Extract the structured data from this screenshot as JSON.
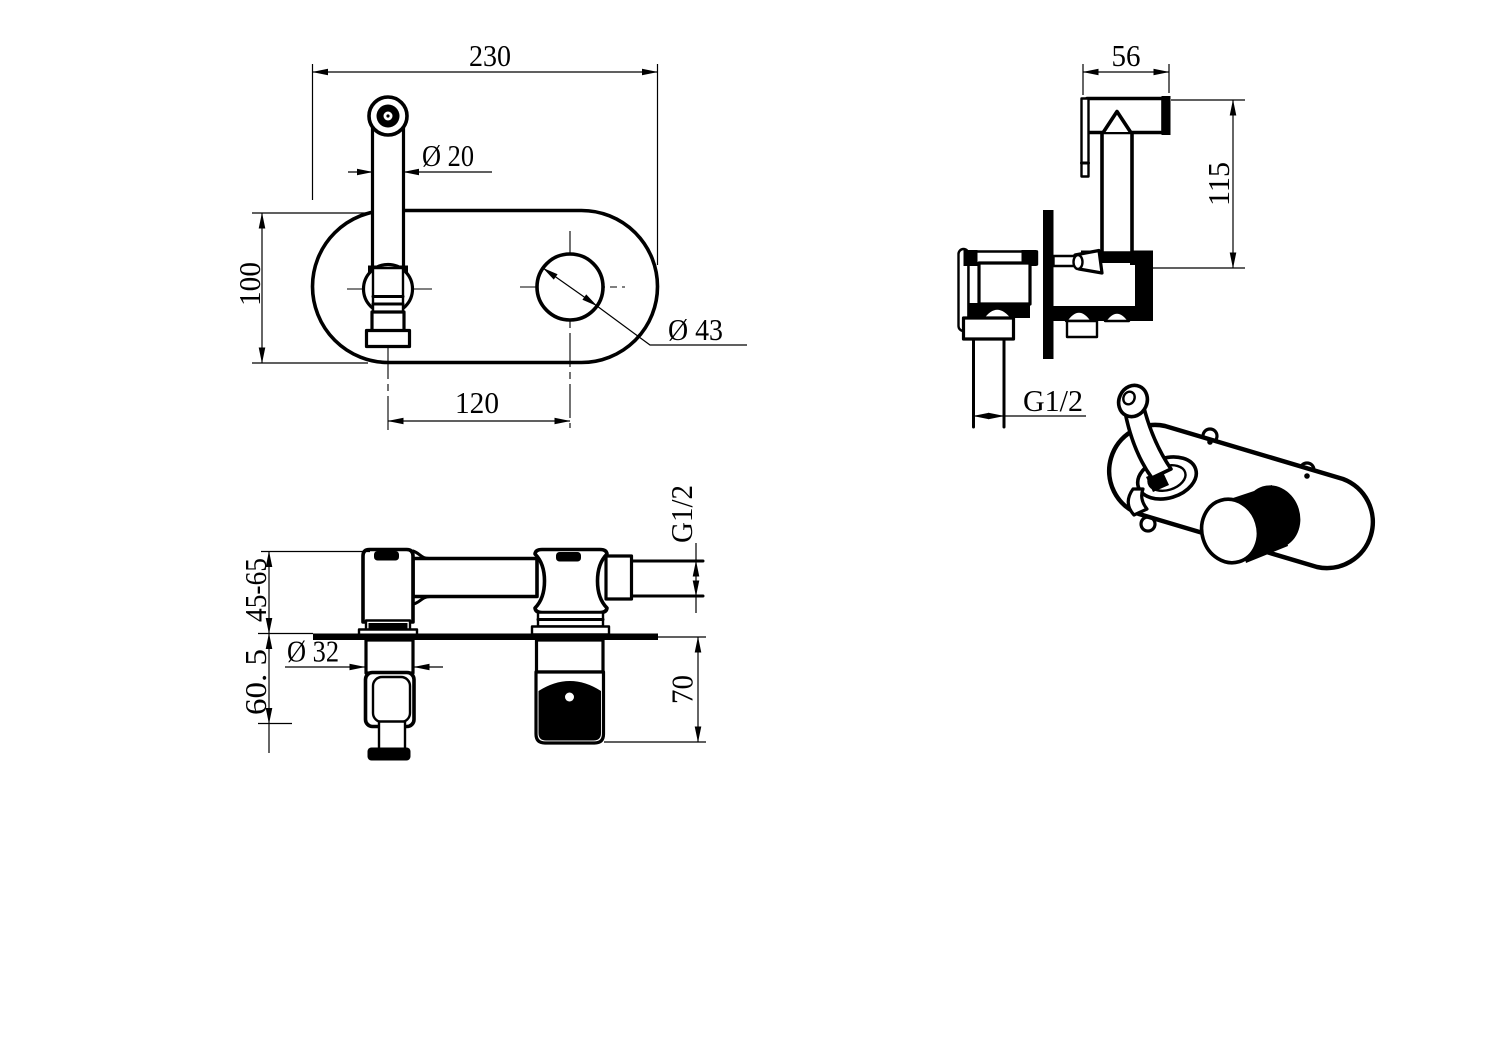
{
  "colors": {
    "ink": "#000000",
    "paper": "#ffffff"
  },
  "views": {
    "front_view": {
      "dim_plate_width": "230",
      "dim_spout_diameter": "Ø 20",
      "dim_plate_height": "100",
      "dim_hole_spacing": "120",
      "dim_knob_hole_diameter": "Ø 43"
    },
    "side_view": {
      "dim_sprayer_head_width": "56",
      "dim_sprayer_height": "115",
      "dim_outlet_thread": "G1/2"
    },
    "section_view": {
      "dim_wall_depth_range": "45-65",
      "dim_holder_projection": "60. 5",
      "dim_holder_diameter": "Ø 32",
      "dim_handle_projection": "70",
      "dim_inlet_thread": "G1/2"
    }
  }
}
